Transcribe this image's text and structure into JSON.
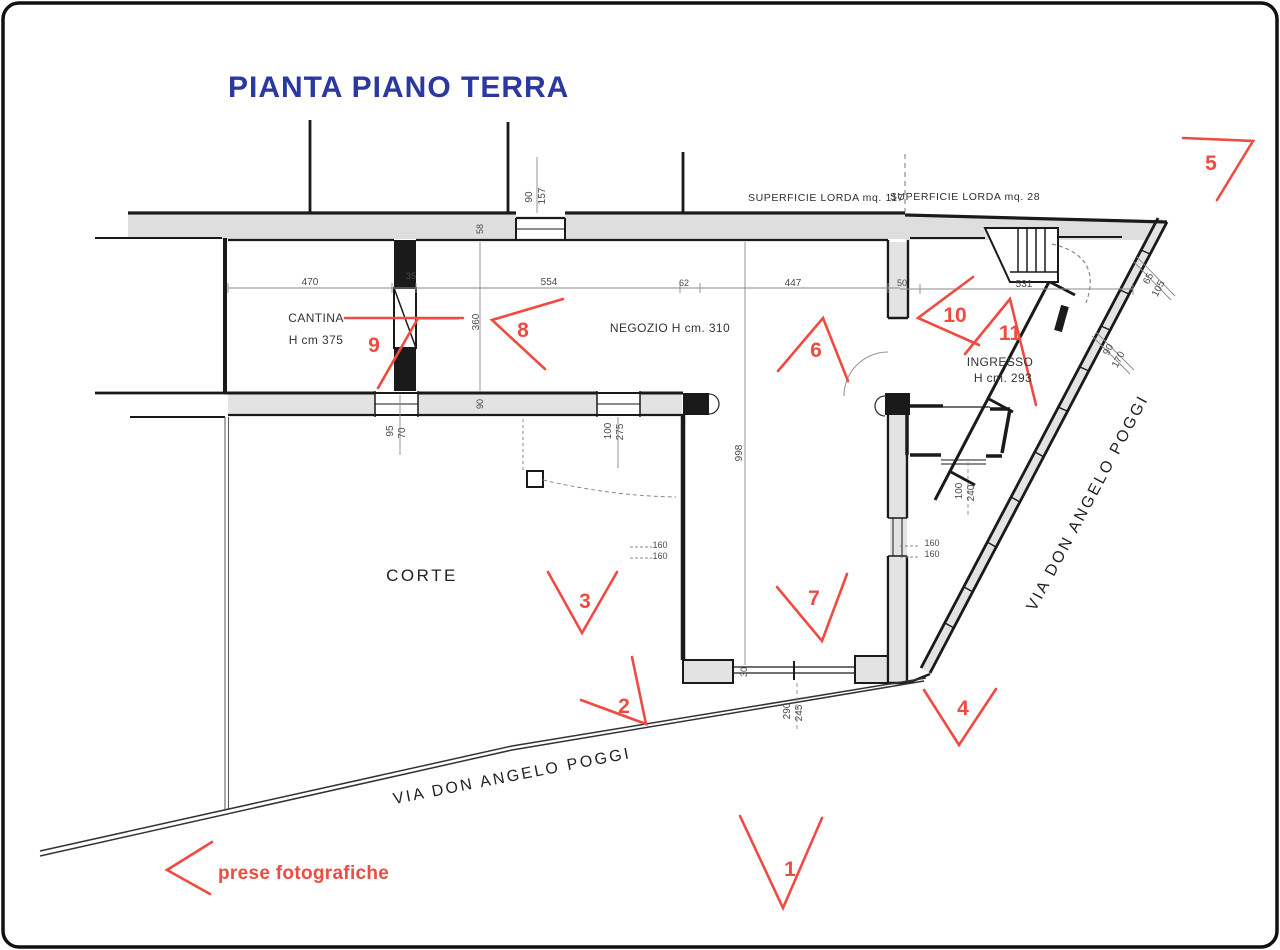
{
  "title": "PIANTA PIANO TERRA",
  "labels": {
    "superficie_left": "SUPERFICIE LORDA mq. 117",
    "superficie_right": "SUPERFICIE LORDA mq. 28",
    "cantina": "CANTINA",
    "cantina_h": "H cm 375",
    "negozio": "NEGOZIO   H cm. 310",
    "ingresso": "INGRESSO",
    "ingresso_h": "H cm. 293",
    "corte": "CORTE",
    "via_bottom": "VIA DON ANGELO POGGI",
    "via_right": "VIA DON ANGELO POGGI",
    "legend": "prese fotografiche"
  },
  "markers": {
    "m1": "1",
    "m2": "2",
    "m3": "3",
    "m4": "4",
    "m5": "5",
    "m6": "6",
    "m7": "7",
    "m8": "8",
    "m9": "9",
    "m10": "10",
    "m11": "11"
  },
  "dims": {
    "d470": "470",
    "d35": "35",
    "d554": "554",
    "d62": "62",
    "d447": "447",
    "d50": "50",
    "d531": "531",
    "d58": "58",
    "d90_top": "90",
    "d157": "157",
    "d360": "360",
    "d998": "998",
    "d95": "95",
    "d70": "70",
    "d90_win": "90",
    "d100_a": "100",
    "d275": "275",
    "d160_a1": "160",
    "d160_a2": "160",
    "d160_b1": "160",
    "d160_b2": "160",
    "d100_b": "100",
    "d240": "240",
    "d290": "290",
    "d245": "245",
    "d30": "30",
    "d65": "65",
    "d105": "105",
    "d90_r": "90",
    "d170": "170"
  },
  "colors": {
    "marker_red": "#ee4b42",
    "title_blue": "#2a38a0",
    "wall_black": "#1a1a1a",
    "dim_text": "#4a4a4a"
  }
}
